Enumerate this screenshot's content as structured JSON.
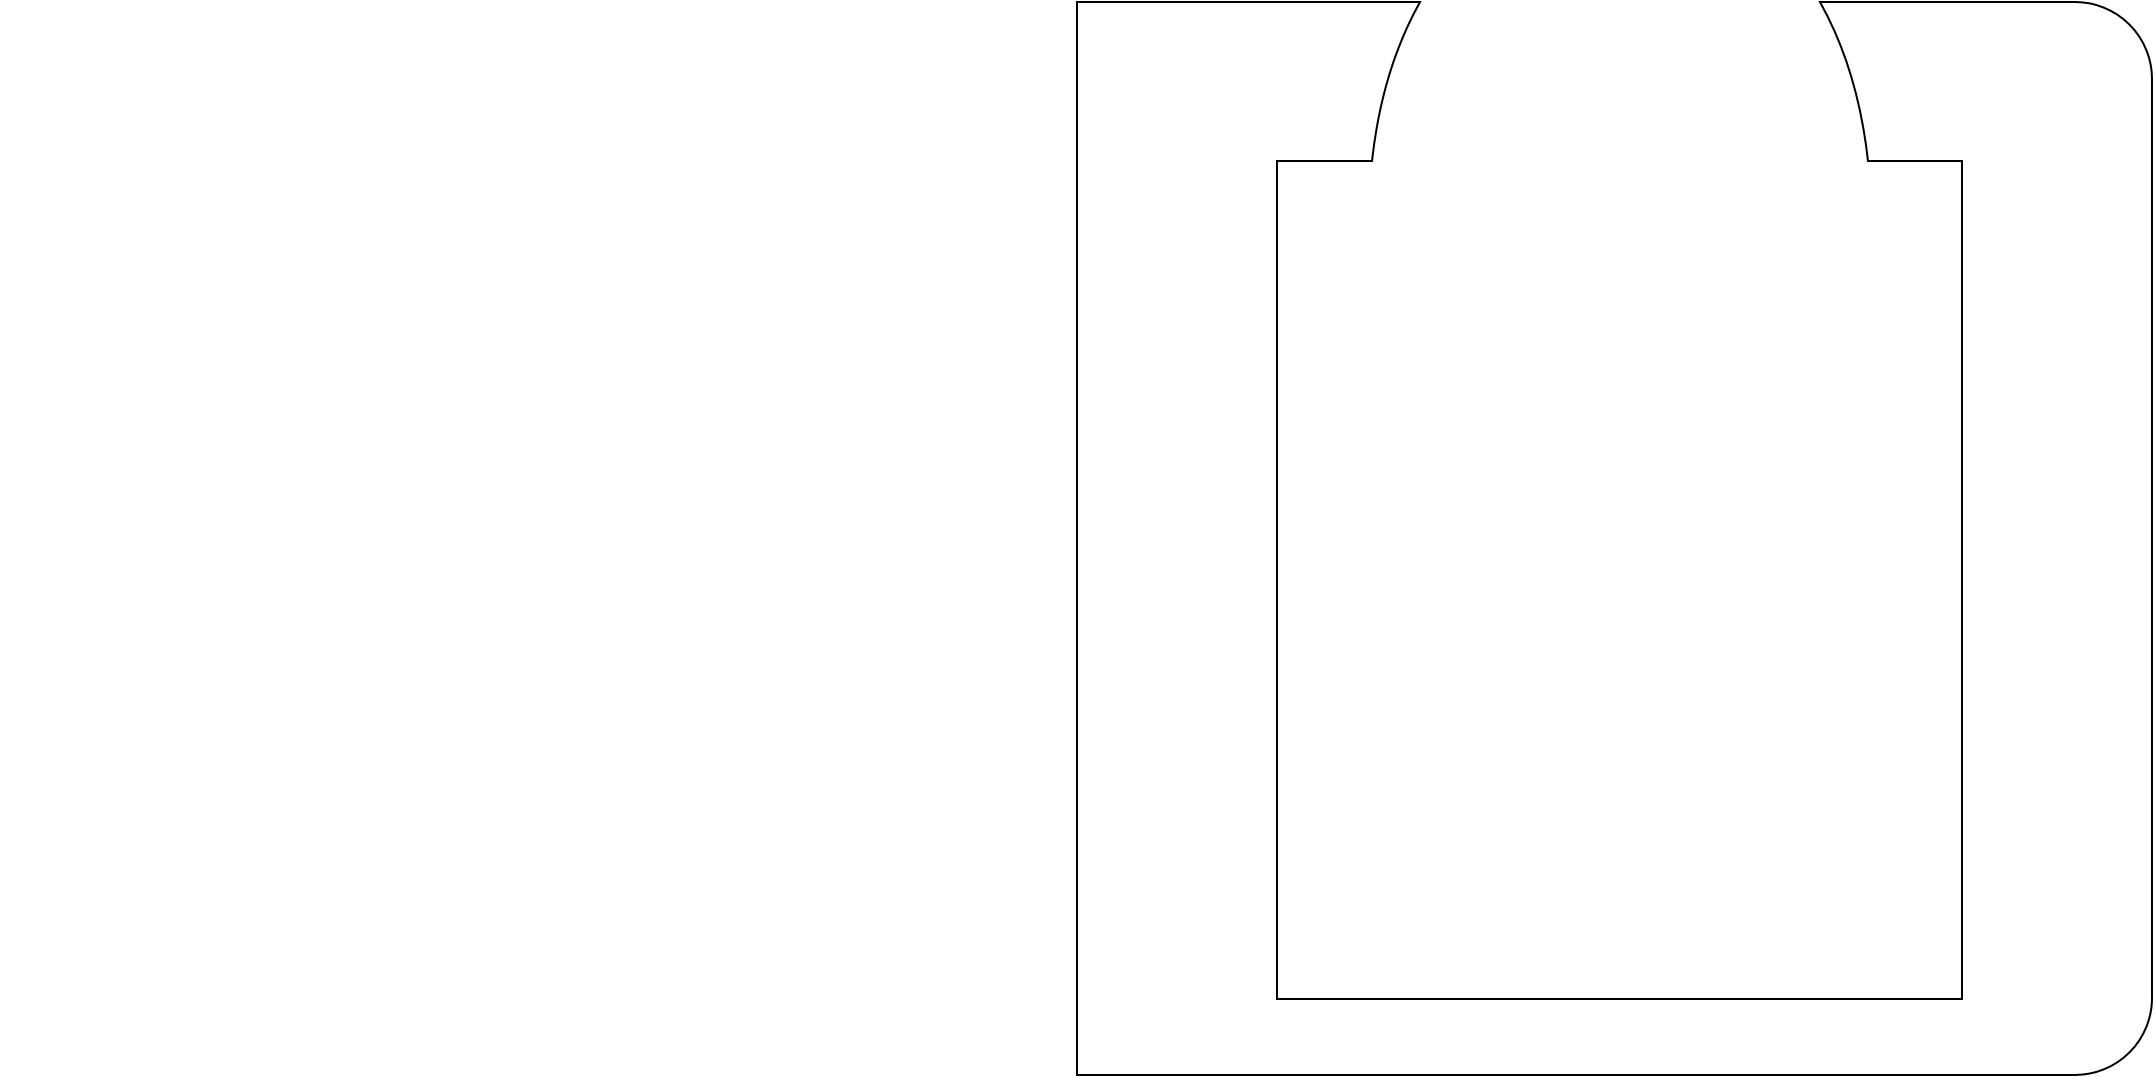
{
  "canvas": {
    "width": 2154,
    "height": 1077,
    "viewbox": "0 0 2154 1077",
    "background": "#ffffff"
  },
  "drawing": {
    "label": "closed profile outline: outer plate with sharp left corners and rounded right corners, top opening with flared neck curves leading into a deep rectangular pocket",
    "stroke_color": "#000000",
    "stroke_width": 2,
    "fill": "none",
    "outer": {
      "left_x": 1077,
      "top_y": 2,
      "right_x": 2152,
      "bottom_y": 1075,
      "corner_radius_right": 77
    },
    "pocket": {
      "left_x": 1277,
      "right_x": 1962,
      "top_y": 161,
      "bottom_y": 999,
      "opening_top_left_x": 1420,
      "opening_top_right_x": 1820,
      "rim_left_x": 1372,
      "rim_right_x": 1868
    },
    "path": "M 1077 2 L 1420 2 Q 1382 70 1372 161 L 1277 161 L 1277 999 L 1962 999 L 1962 161 L 1868 161 Q 1858 70 1820 2 L 2075 2 A 77 77 0 0 1 2152 79 L 2152 998 A 77 77 0 0 1 2075 1075 L 1077 1075 Z"
  }
}
